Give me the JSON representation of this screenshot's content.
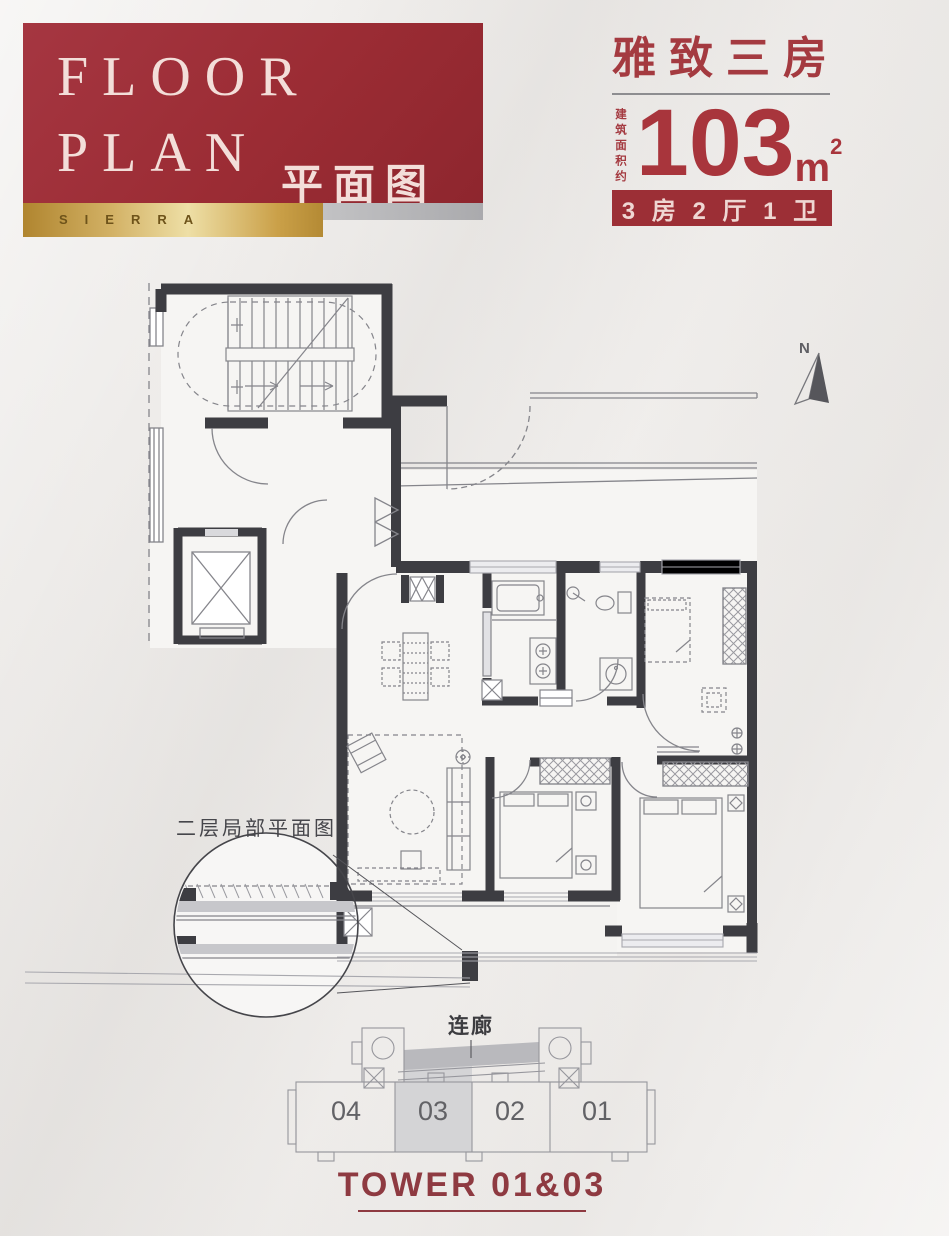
{
  "header": {
    "title_line1": "FLOOR",
    "title_line2": "PLAN",
    "title_cn": "平面图",
    "brand": "SIERRA"
  },
  "unit": {
    "name": "雅致三房",
    "area_prefix": "建筑面积约",
    "area_value": "103",
    "area_unit": "m",
    "area_exp": "2",
    "spec_badge": "3 房 2 厅 1 卫"
  },
  "plan": {
    "north": "N",
    "detail_note": "二层局部平面图"
  },
  "footprint": {
    "bridge_label": "连廊",
    "units": [
      "04",
      "03",
      "02",
      "01"
    ],
    "highlighted_unit": "03",
    "tower_title": "TOWER 01&03"
  },
  "colors": {
    "banner_red": "#9b2c34",
    "accent_red": "#a43a40",
    "badge_red": "#9c2f36",
    "gold": "#caa048",
    "wall": "#3d3d42"
  }
}
